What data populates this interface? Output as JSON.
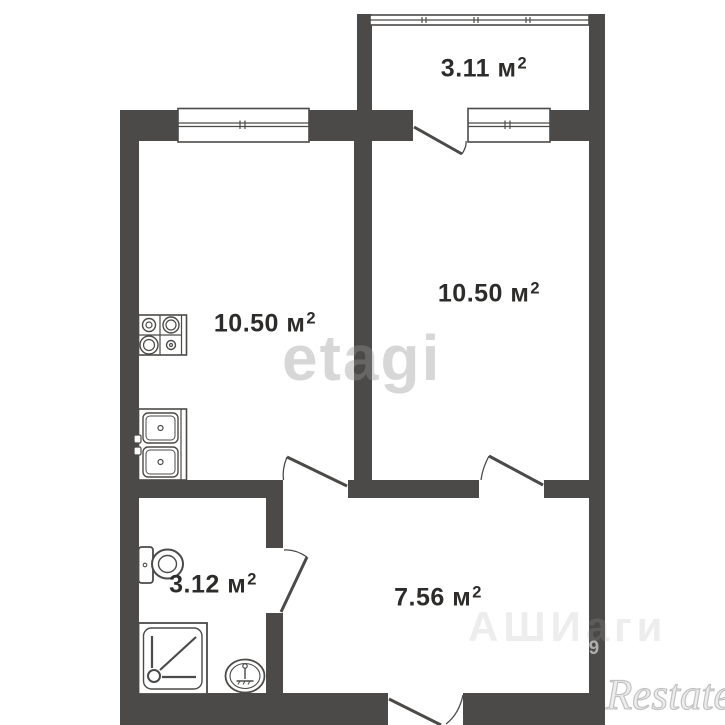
{
  "plan": {
    "type": "apartment-floor-plan",
    "rooms": {
      "balcony": {
        "area_text": "3.11 м",
        "sup": "2"
      },
      "kitchen": {
        "area_text": "10.50 м",
        "sup": "2"
      },
      "room": {
        "area_text": "10.50 м",
        "sup": "2"
      },
      "bathroom": {
        "area_text": "3.12 м",
        "sup": "2"
      },
      "hallway": {
        "area_text": "7.56 м",
        "sup": "2"
      }
    },
    "fixtures": [
      "stove",
      "kitchen-sink",
      "toilet",
      "shower-tray",
      "washbasin"
    ],
    "watermarks": {
      "brand_center": "etagi",
      "brand_corner": "Restate",
      "faint_text": "АШИаги",
      "wall_digits": "39"
    },
    "colors": {
      "wall": "#4b4a48",
      "background": "#ffffff",
      "label": "#2d2c2a"
    }
  }
}
